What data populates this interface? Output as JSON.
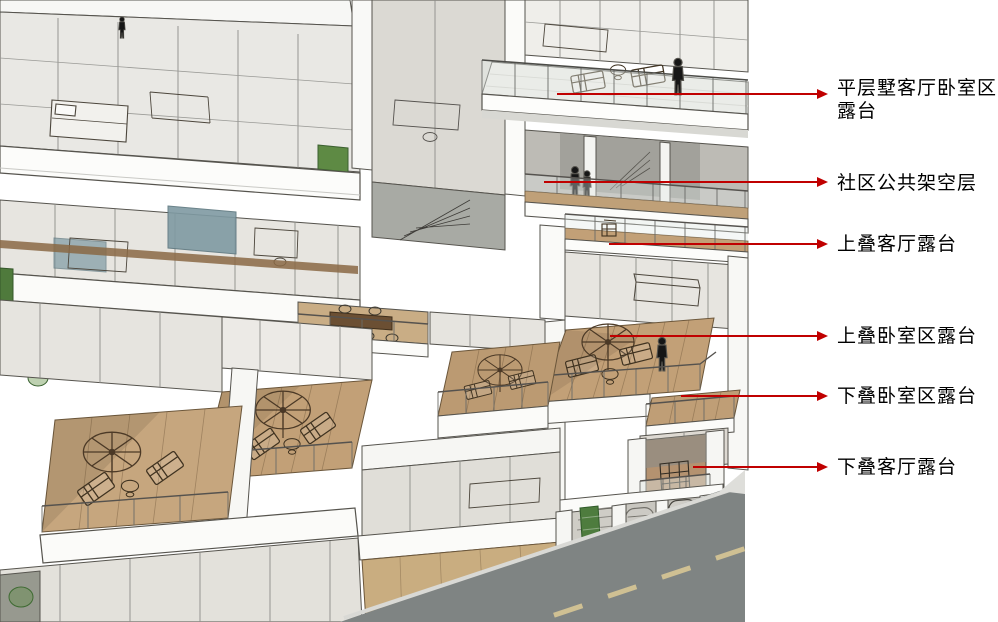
{
  "palette": {
    "background": "#ffffff",
    "arrow_red": "#c00000",
    "label_text": "#000000",
    "deck_wood": "#c2a077",
    "road_gray": "#7f8483",
    "accent_green": "#5e8a44",
    "glass": "#e7e5e0",
    "figure_black": "#161616"
  },
  "callouts": [
    {
      "name": "flat-villa-living-bedroom-terrace",
      "lines": [
        "平层墅客厅卧室区",
        "露台"
      ],
      "arrow": {
        "x1": 557,
        "x2": 828,
        "y": 94
      },
      "label": {
        "x": 837,
        "y": 77
      }
    },
    {
      "name": "community-open-floor",
      "lines": [
        "社区公共架空层"
      ],
      "arrow": {
        "x1": 544,
        "x2": 828,
        "y": 182
      },
      "label": {
        "x": 837,
        "y": 172
      }
    },
    {
      "name": "upper-duplex-living-terrace",
      "lines": [
        "上叠客厅露台"
      ],
      "arrow": {
        "x1": 609,
        "x2": 828,
        "y": 244
      },
      "label": {
        "x": 837,
        "y": 233
      }
    },
    {
      "name": "upper-duplex-bedroom-terrace",
      "lines": [
        "上叠卧室区露台"
      ],
      "arrow": {
        "x1": 610,
        "x2": 828,
        "y": 336
      },
      "label": {
        "x": 837,
        "y": 325
      }
    },
    {
      "name": "lower-duplex-bedroom-terrace",
      "lines": [
        "下叠卧室区露台"
      ],
      "arrow": {
        "x1": 681,
        "x2": 828,
        "y": 396
      },
      "label": {
        "x": 837,
        "y": 385
      }
    },
    {
      "name": "lower-duplex-living-terrace",
      "lines": [
        "下叠客厅露台"
      ],
      "arrow": {
        "x1": 693,
        "x2": 828,
        "y": 467
      },
      "label": {
        "x": 837,
        "y": 456
      }
    }
  ]
}
